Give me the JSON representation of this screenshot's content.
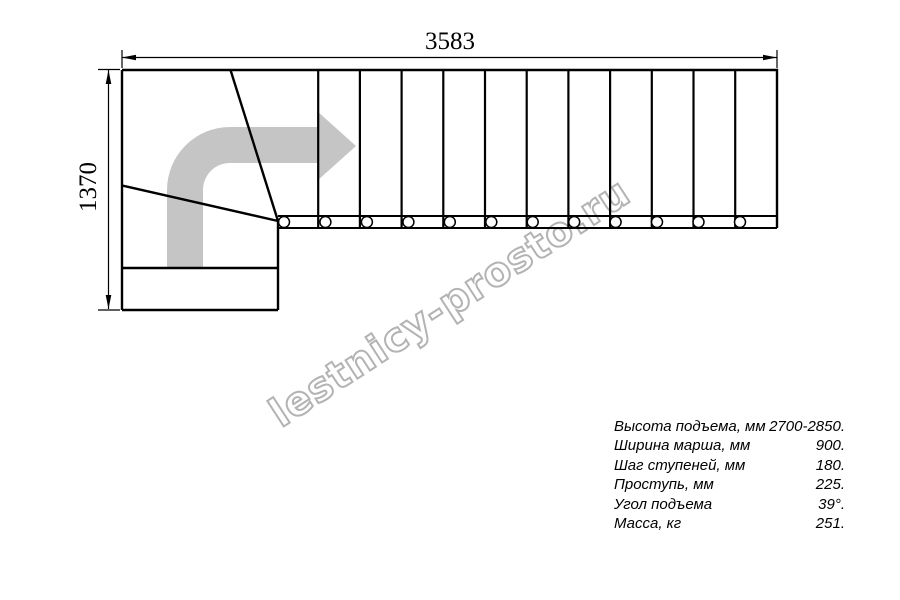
{
  "watermark": {
    "text": "lestnicy-prosto.ru",
    "outline_color": "#b3b3b3"
  },
  "dimensions": {
    "total_length_mm": "3583",
    "total_depth_mm": "1370"
  },
  "drawing": {
    "straight_step_lines": 11,
    "baluster_count": 12,
    "arrow_color": "#c5c5c5",
    "line_color": "#000000"
  },
  "specs": {
    "rows": [
      {
        "label": "Высота подъема, мм",
        "value": "2700-2850."
      },
      {
        "label": "Ширина марша, мм",
        "value": "900."
      },
      {
        "label": "Шаг ступеней, мм",
        "value": "180."
      },
      {
        "label": "Проступь, мм",
        "value": "225."
      },
      {
        "label": "Угол подъема",
        "value": "39°."
      },
      {
        "label": "Масса, кг",
        "value": "251."
      }
    ]
  }
}
